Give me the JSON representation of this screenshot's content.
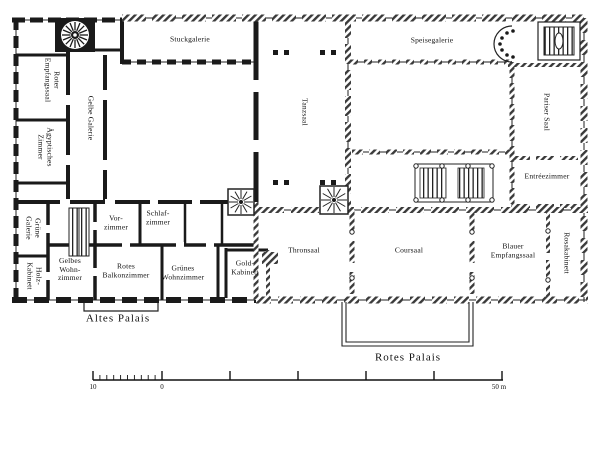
{
  "figure": {
    "type": "architectural floor plan",
    "subject": "Palace plan showing Altes Palais and Rotes Palais"
  },
  "palette": {
    "ink": "#1a1a1a",
    "paper": "#ffffff"
  },
  "rooms": {
    "stuckgalerie": "Stuckgalerie",
    "speisegalerie": "Speisegalerie",
    "tanzsaal": "Tanzsaal",
    "pariser_saal": "Pariser Saal",
    "entreezimmer": "Entréezimmer",
    "roter_empfangssaal": "Roter\nEmpfangssaal",
    "gelbe_galerie": "Gelbe Galerie",
    "aegyptisches_zimmer": "Ägyptisches\nZimmer",
    "gruene_galerie": "Grüne\nGalerie",
    "holz_kabinett": "Holz-\nKabinett",
    "gelbes_wohnzimmer": "Gelbes\nWohn-\nzimmer",
    "rotes_balkonzimmer": "Rotes\nBalkonzimmer",
    "gruenes_wohnzimmer": "Grünes\nWohnzimmer",
    "vorzimmer": "Vor-\nzimmer",
    "schlafzimmer": "Schlaf-\nzimmer",
    "gold_kabinett": "Gold-\nKabinett",
    "thronsaal": "Thronsaal",
    "coursaal": "Coursaal",
    "blauer_empfangssaal": "Blauer\nEmpfangssaal",
    "rosakabinett": "Rosakabinett"
  },
  "captions": {
    "altes_palais": "Altes Palais",
    "rotes_palais": "Rotes Palais"
  },
  "scalebar": {
    "left_label": "10",
    "zero_label": "0",
    "right_label": "50 m"
  }
}
